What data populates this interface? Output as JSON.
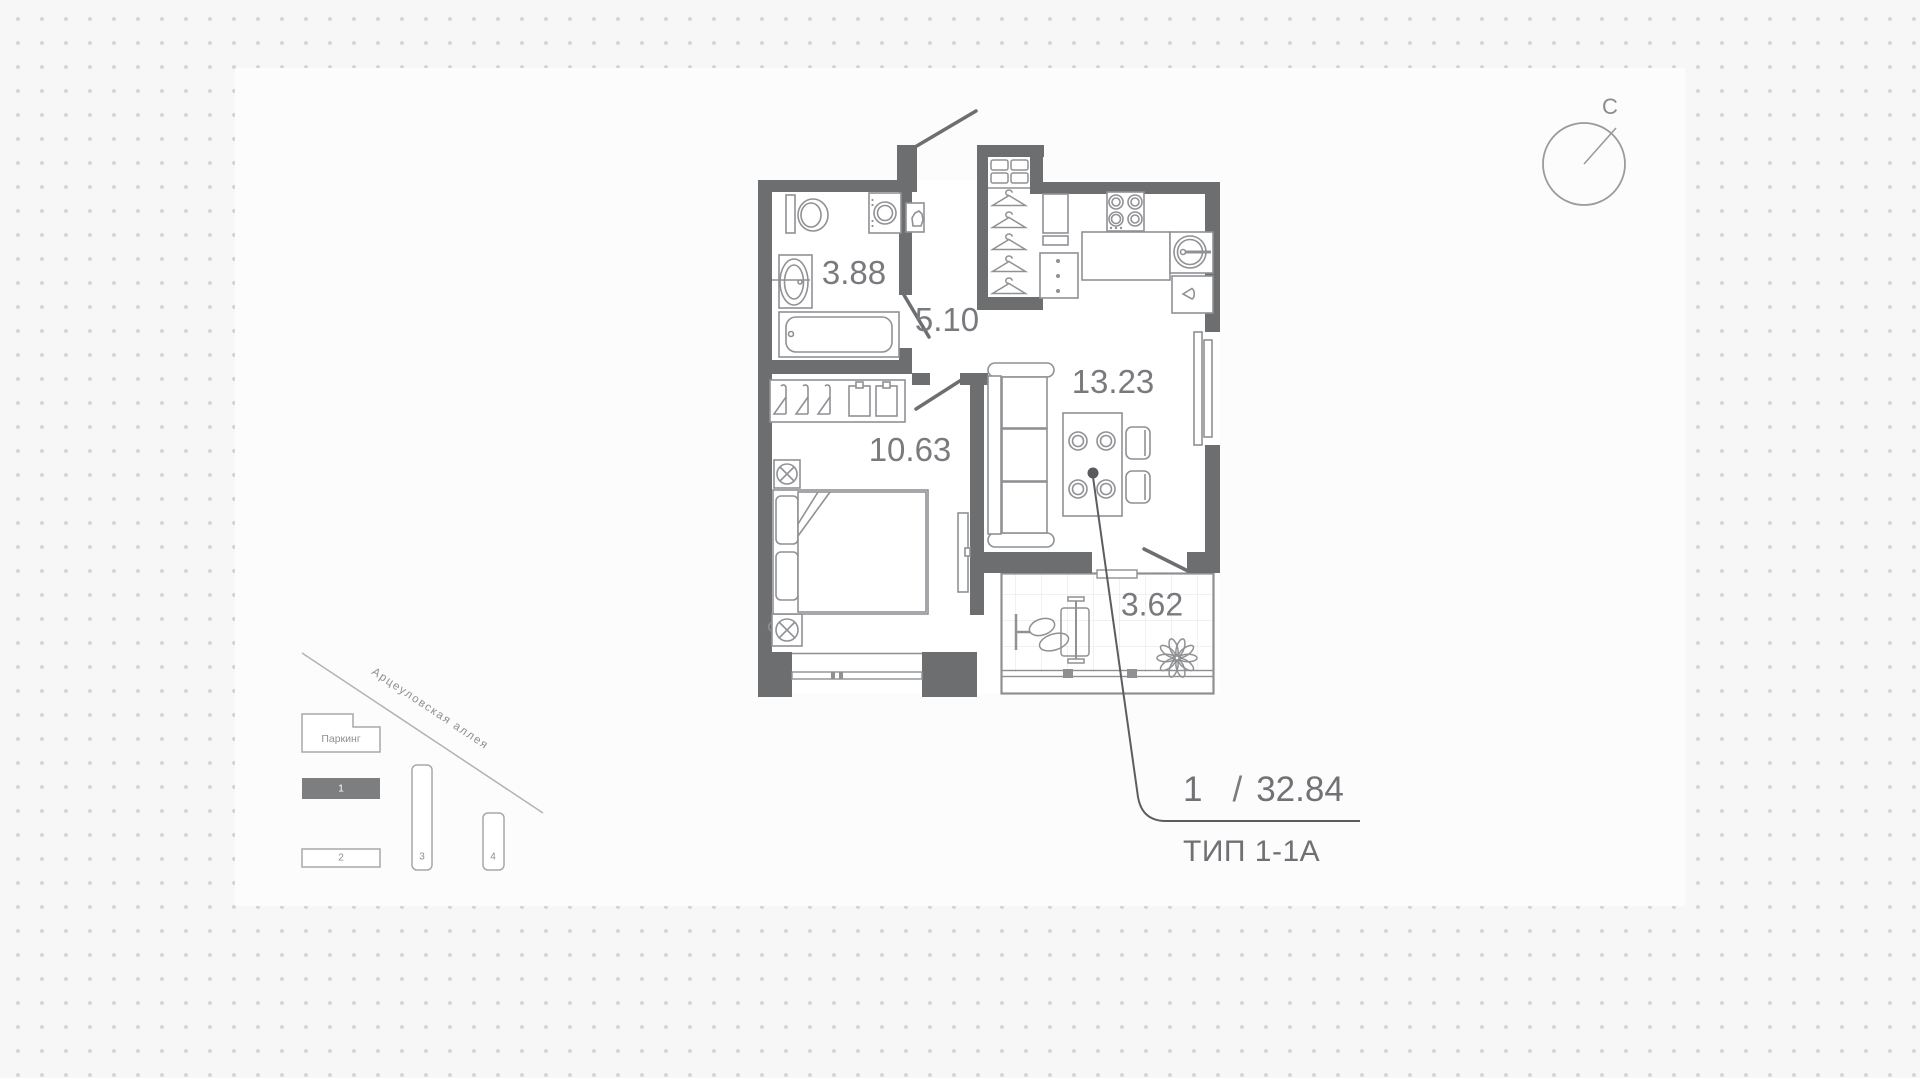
{
  "compass": {
    "label": "С"
  },
  "plan": {
    "rooms": [
      {
        "name": "bathroom",
        "area": "3.88"
      },
      {
        "name": "hallway",
        "area": "5.10"
      },
      {
        "name": "bedroom",
        "area": "10.63"
      },
      {
        "name": "kitchen-living",
        "area": "13.23"
      },
      {
        "name": "balcony",
        "area": "3.62"
      }
    ],
    "callout": {
      "rooms_count": "1",
      "separator": "/",
      "total_area": "32.84",
      "type_label": "ТИП 1-1А"
    }
  },
  "minimap": {
    "street": "Арцеуловская аллея",
    "parking_label": "Паркинг",
    "buildings": [
      {
        "label": "1",
        "highlighted": true
      },
      {
        "label": "2",
        "highlighted": false
      },
      {
        "label": "3",
        "highlighted": false
      },
      {
        "label": "4",
        "highlighted": false
      }
    ]
  },
  "colors": {
    "wall": "#6d6e70",
    "fixture_stroke": "#909194",
    "label_text": "#797a7d",
    "leader": "#5c5d60",
    "dots": "#d6d6d7",
    "minimap_stroke": "#a7a8aa",
    "minimap_highlight_fill": "#7d7e80"
  }
}
